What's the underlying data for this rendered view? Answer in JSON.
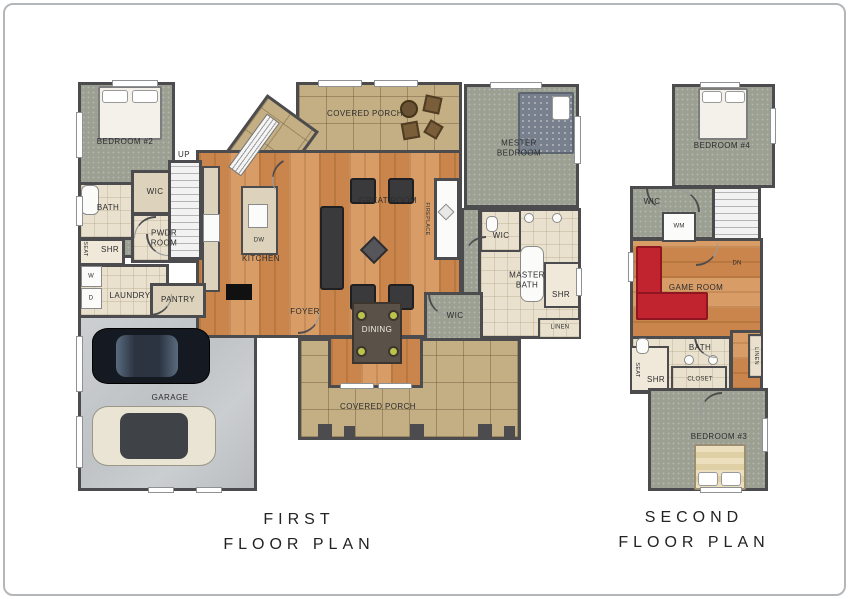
{
  "palette": {
    "wall": "#4c4c4e",
    "wood_floor": "#cd9058",
    "carpet": "#9ca092",
    "porch_tile": "#c4ae83",
    "bath_tile": "#e9e1ce",
    "garage_concrete": "#c7cacc",
    "sectional_red": "#c2242f",
    "dining_chair_green": "#b9c44b",
    "frame_border": "#b3b7ba"
  },
  "first": {
    "title1": "FIRST",
    "title2": "FLOOR PLAN",
    "labels": {
      "bedroom2": "BEDROOM #2",
      "wic_hall": "WIC",
      "bath": "BATH",
      "seat": "SEAT",
      "shr": "SHR",
      "pwdr_room": "PWDR ROOM",
      "washer": "W",
      "dryer": "D",
      "laundry": "LAUNDRY",
      "up": "UP",
      "kitchen": "KITCHEN",
      "dishwasher": "DW",
      "pantry": "PANTRY",
      "great_room": "GREAT ROOM",
      "covered_porch_top": "COVERED PORCH",
      "mester_bedroom": "MESTER BEDROOM",
      "fireplace": "FIREPLACE",
      "wic_master": "WIC",
      "master_bath": "MASTER BATH",
      "shr_master": "SHR",
      "linen": "LINEN",
      "wic_dining": "WIC",
      "foyer": "FOYER",
      "dining": "DINING",
      "garage": "GARAGE",
      "covered_porch_bottom": "COVERED PORCH"
    }
  },
  "second": {
    "title1": "SECOND",
    "title2": "FLOOR PLAN",
    "labels": {
      "bedroom4": "BEDROOM #4",
      "wic": "WIC",
      "wm": "WM",
      "dn": "DN",
      "game_room": "GAME ROOM",
      "bath": "BATH",
      "seat": "SEAT",
      "shr": "SHR",
      "closet": "CLOSET",
      "linen": "LINEN",
      "bedroom3": "BEDROOM #3"
    }
  }
}
